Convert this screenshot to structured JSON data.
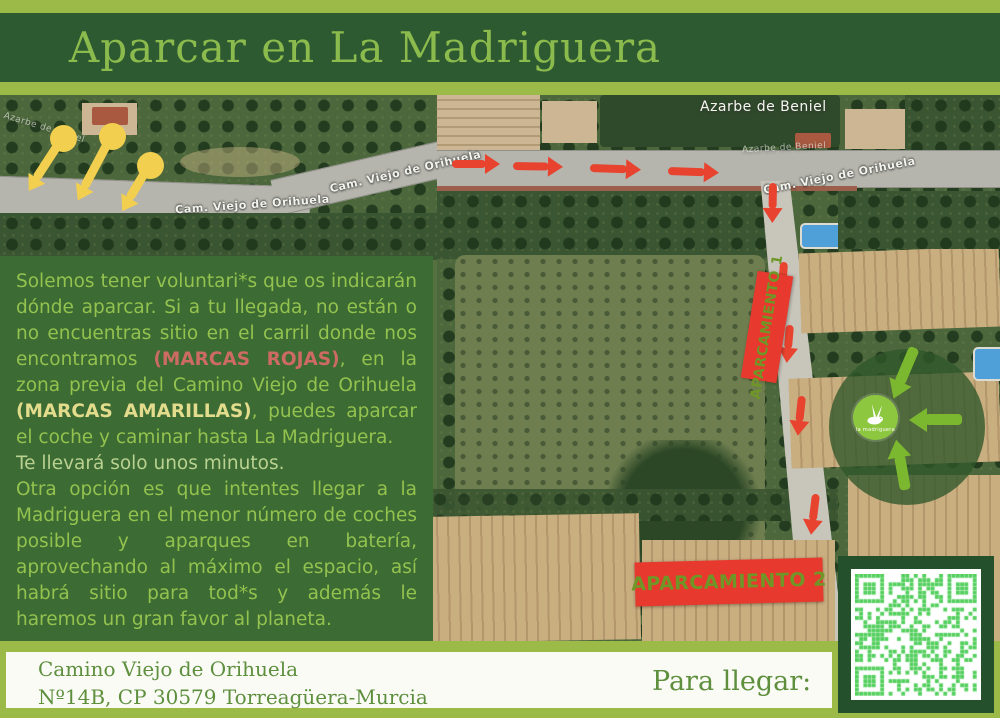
{
  "colors": {
    "page-bg": "#9cba48",
    "header-bar": "#2e5a31",
    "title": "#8cbb4d",
    "panel-bg": "#3c6b33",
    "panel-text": "#93c24f",
    "marcas-rojas": "#cd6b62",
    "marcas-amarillas": "#e3dc8d",
    "arrow-red": "#e8432f",
    "marker-yellow": "#f2cf4e",
    "box-red": "#e8392e",
    "box-text": "#6f9727",
    "green-arrow": "#7cb82f",
    "big-circle": "rgba(47,87,42,0.78)",
    "logo-green": "#8dc63f",
    "footer-text": "#5d8f3d",
    "qr-frame": "#24512b",
    "qr-module": "#52cf5c",
    "qr-bg": "#ffffff"
  },
  "header": {
    "title": "Aparcar en La Madriguera"
  },
  "map": {
    "street_label": "Cam. Viejo de Orihuela",
    "water_label": "Azarbe de Beniel",
    "parking1_label": "APARCAMIENTO 1",
    "parking2_label": "APARCAMIENTO 2",
    "logo_text": "la madriguera"
  },
  "info_panel": {
    "p1_before_red": "Solemos tener voluntari*s que os indicarán dónde aparcar. Si a tu llegada, no están o no encuentras sitio en el carril donde nos encontramos ",
    "red_highlight": "(MARCAS ROJAS)",
    "p1_middle": ", en la zona previa del Camino Viejo de Orihuela ",
    "yellow_highlight": "(MARCAS AMARILLAS)",
    "p1_after": ", puedes aparcar el coche y caminar hasta La Madriguera.",
    "line_minutes": "Te llevará solo unos minutos.",
    "p2": "Otra opción es que intentes llegar a la Madriguera en el menor número de coches posible y aparques en batería, aprovechando al máximo el espacio, así habrá sitio para tod*s y además le haremos un gran favor al planeta."
  },
  "footer": {
    "address_line1": "Camino Viejo de Orihuela",
    "address_line2": "Nº14B,  CP 30579 Torreagüera-Murcia",
    "cta": "Para llegar:"
  }
}
